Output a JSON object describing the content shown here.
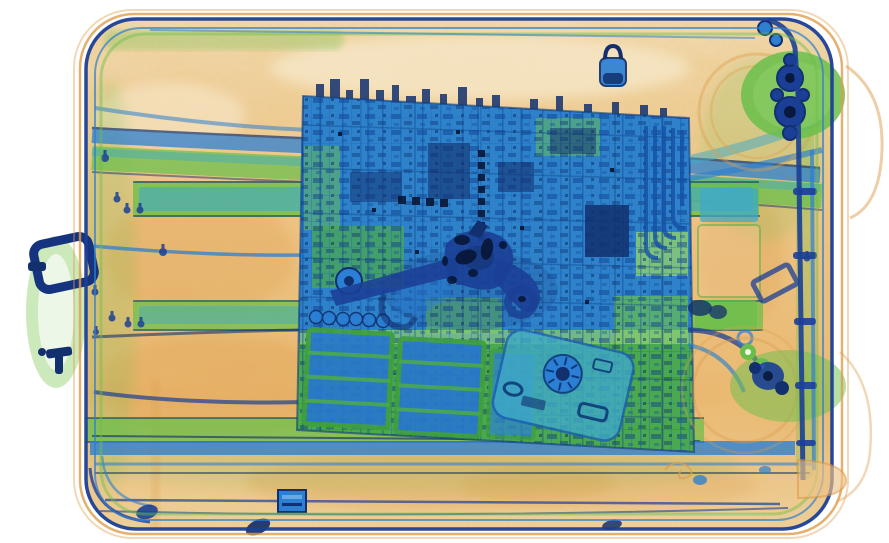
{
  "scene": {
    "type": "airport-security-xray-baggage-scan",
    "description": "Dual-energy X-ray scan of a wheeled suitcase: orange tones indicate organic material (fabric), green indicates mixed/low-density material, blue indicates dense metal. Inside the bag is a large electronics assembly (circuit board with components, two striped battery packs, a disk/optical drive) and a concealed revolver at the center. Metal wheels hubs, telescopic handle tubes, a carry handle, a padlock and strap buckles are visible.",
    "objects": [
      {
        "name": "suitcase-shell",
        "material": "organic-orange"
      },
      {
        "name": "luggage-straps",
        "material": "mixed-green"
      },
      {
        "name": "circuit-board",
        "material": "metal-blue-on-green"
      },
      {
        "name": "battery-pack-left",
        "material": "metal-blue"
      },
      {
        "name": "battery-pack-right",
        "material": "metal-blue"
      },
      {
        "name": "disk-drive",
        "material": "metal-teal"
      },
      {
        "name": "revolver",
        "material": "dense-metal-navy"
      },
      {
        "name": "padlock",
        "material": "metal-blue"
      },
      {
        "name": "strap-buckle",
        "material": "metal-blue"
      },
      {
        "name": "carry-handle",
        "material": "metal-navy"
      },
      {
        "name": "telescopic-handle-tubes",
        "material": "metal-blue"
      },
      {
        "name": "top-right-wheel",
        "material": "green-with-metal-hub"
      },
      {
        "name": "bottom-right-wheel",
        "material": "green-with-metal-hub"
      }
    ]
  },
  "colors": {
    "background": "#ffffff",
    "organic-light": "#f7e8cb",
    "organic-mid": "#eec488",
    "organic-deep": "#dd9e4e",
    "mixed-green": "#6abf4b",
    "green-light": "#8fcf6a",
    "teal": "#3fa9c8",
    "metal-blue": "#2e7fd0",
    "metal-mid": "#2b7fd4",
    "metal-deep": "#1b3f96",
    "metal-dark": "#12306e",
    "ink": "#06122e",
    "pcb-green": "#4aa84e"
  }
}
